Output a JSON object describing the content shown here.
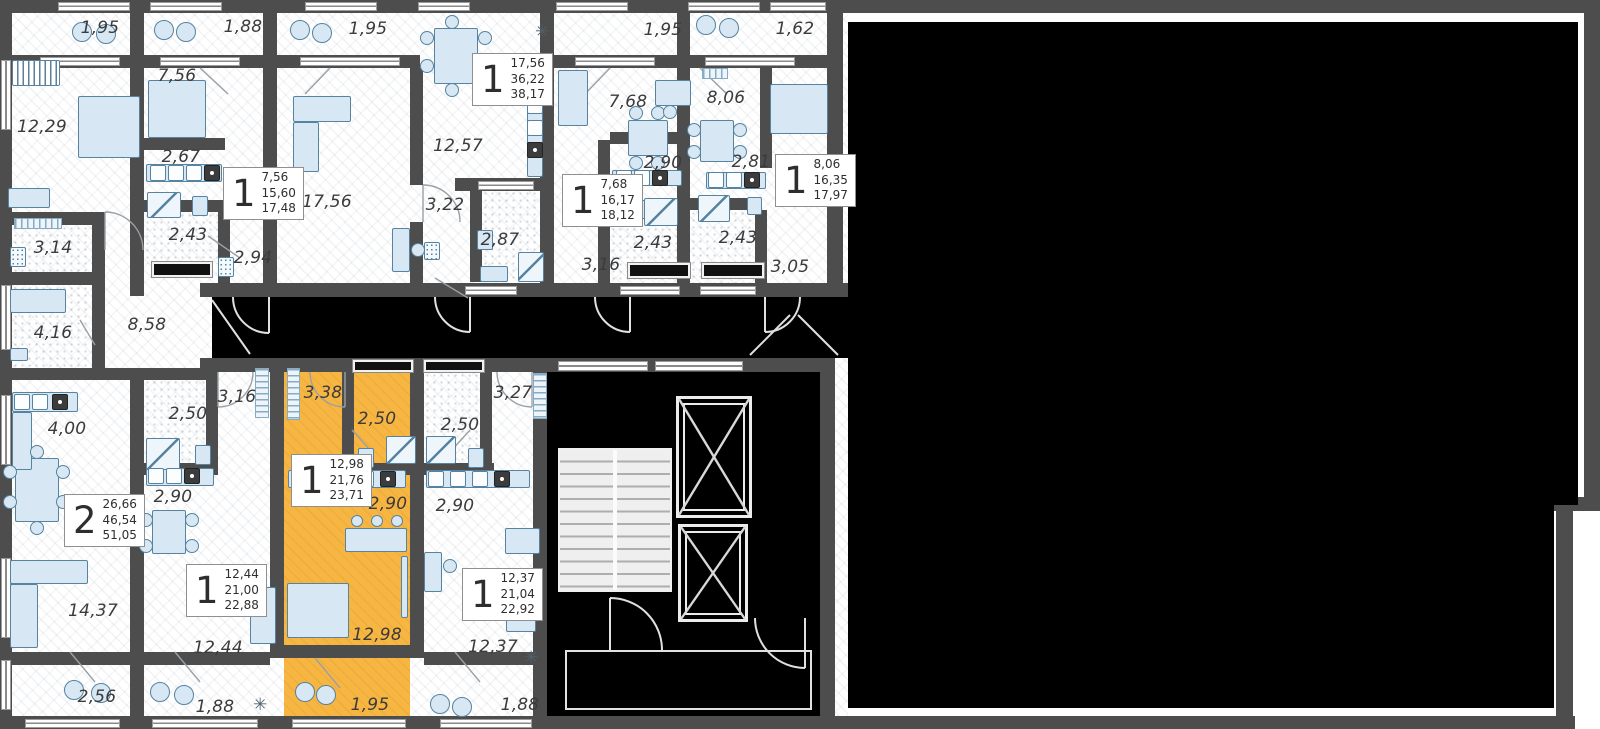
{
  "colors": {
    "highlight": "#F7B542",
    "wall": "#4D4D4D",
    "furniture_fill": "#D7E8F4",
    "furniture_stroke": "#56839F",
    "redaction": "#000000",
    "label": "#3B3B3B"
  },
  "room_labels": [
    {
      "text": "1,95",
      "x": 100,
      "y": 28
    },
    {
      "text": "1,88",
      "x": 243,
      "y": 27
    },
    {
      "text": "1,95",
      "x": 368,
      "y": 29
    },
    {
      "text": "1,95",
      "x": 663,
      "y": 30
    },
    {
      "text": "1,62",
      "x": 795,
      "y": 29
    },
    {
      "text": "12,29",
      "x": 42,
      "y": 127
    },
    {
      "text": "7,56",
      "x": 177,
      "y": 76
    },
    {
      "text": "2,67",
      "x": 181,
      "y": 157
    },
    {
      "text": "17,56",
      "x": 327,
      "y": 202
    },
    {
      "text": "12,57",
      "x": 458,
      "y": 146
    },
    {
      "text": "3,22",
      "x": 445,
      "y": 205
    },
    {
      "text": "2,87",
      "x": 500,
      "y": 240
    },
    {
      "text": "7,68",
      "x": 628,
      "y": 102
    },
    {
      "text": "2,90",
      "x": 663,
      "y": 163
    },
    {
      "text": "2,43",
      "x": 653,
      "y": 243
    },
    {
      "text": "3,16",
      "x": 601,
      "y": 265
    },
    {
      "text": "8,06",
      "x": 726,
      "y": 98
    },
    {
      "text": "2,81",
      "x": 751,
      "y": 162
    },
    {
      "text": "2,43",
      "x": 738,
      "y": 238
    },
    {
      "text": "3,05",
      "x": 790,
      "y": 267
    },
    {
      "text": "3,14",
      "x": 53,
      "y": 248
    },
    {
      "text": "2,43",
      "x": 188,
      "y": 235
    },
    {
      "text": "2,94",
      "x": 253,
      "y": 258
    },
    {
      "text": "4,16",
      "x": 53,
      "y": 333
    },
    {
      "text": "8,58",
      "x": 147,
      "y": 325
    },
    {
      "text": "4,00",
      "x": 67,
      "y": 429
    },
    {
      "text": "2,50",
      "x": 188,
      "y": 414
    },
    {
      "text": "2,90",
      "x": 173,
      "y": 497
    },
    {
      "text": "3,16",
      "x": 237,
      "y": 397
    },
    {
      "text": "3,38",
      "x": 323,
      "y": 393
    },
    {
      "text": "2,50",
      "x": 377,
      "y": 419
    },
    {
      "text": "2,90",
      "x": 388,
      "y": 504
    },
    {
      "text": "3,27",
      "x": 513,
      "y": 393
    },
    {
      "text": "2,50",
      "x": 460,
      "y": 425
    },
    {
      "text": "2,90",
      "x": 455,
      "y": 506
    },
    {
      "text": "14,37",
      "x": 93,
      "y": 611
    },
    {
      "text": "12,44",
      "x": 218,
      "y": 648
    },
    {
      "text": "12,98",
      "x": 377,
      "y": 635
    },
    {
      "text": "12,37",
      "x": 493,
      "y": 647
    },
    {
      "text": "2,56",
      "x": 97,
      "y": 697
    },
    {
      "text": "1,88",
      "x": 215,
      "y": 707
    },
    {
      "text": "1,95",
      "x": 370,
      "y": 705
    },
    {
      "text": "1,88",
      "x": 520,
      "y": 705
    }
  ],
  "unit_badges": [
    {
      "digit": "1",
      "areas": [
        "7,56",
        "15,60",
        "17,48"
      ],
      "x": 223,
      "y": 167,
      "selected": false
    },
    {
      "digit": "1",
      "areas": [
        "17,56",
        "36,22",
        "38,17"
      ],
      "x": 472,
      "y": 53,
      "selected": false
    },
    {
      "digit": "1",
      "areas": [
        "7,68",
        "16,17",
        "18,12"
      ],
      "x": 562,
      "y": 174,
      "selected": false
    },
    {
      "digit": "1",
      "areas": [
        "8,06",
        "16,35",
        "17,97"
      ],
      "x": 775,
      "y": 154,
      "selected": false
    },
    {
      "digit": "2",
      "areas": [
        "26,66",
        "46,54",
        "51,05"
      ],
      "x": 64,
      "y": 494,
      "selected": false
    },
    {
      "digit": "1",
      "areas": [
        "12,44",
        "21,00",
        "22,88"
      ],
      "x": 186,
      "y": 564,
      "selected": false
    },
    {
      "digit": "1",
      "areas": [
        "12,98",
        "21,76",
        "23,71"
      ],
      "x": 291,
      "y": 454,
      "selected": true
    },
    {
      "digit": "1",
      "areas": [
        "12,37",
        "21,04",
        "22,92"
      ],
      "x": 462,
      "y": 568,
      "selected": false
    }
  ]
}
